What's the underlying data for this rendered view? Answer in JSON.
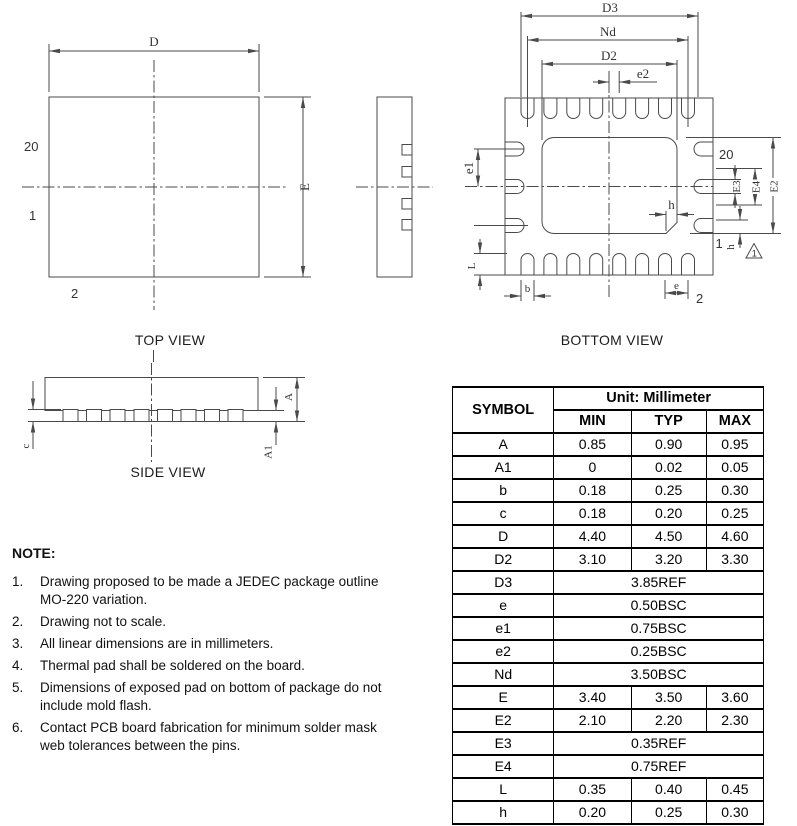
{
  "top_view": {
    "title": "TOP VIEW",
    "dim_d": "D",
    "dim_e": "E",
    "pin20": "20",
    "pin1": "1",
    "pin2": "2"
  },
  "bottom_view": {
    "title": "BOTTOM VIEW",
    "dim_d3": "D3",
    "dim_nd": "Nd",
    "dim_d2": "D2",
    "dim_e2": "e2",
    "dim_e1": "e1",
    "dim_E3": "E3",
    "dim_E4": "E4",
    "dim_E2": "E2",
    "dim_h_chamfer": "h",
    "dim_h_side": "h",
    "dim_L": "L",
    "dim_b": "b",
    "dim_e": "e",
    "pin20": "20",
    "pin1": "1",
    "pin2": "2",
    "rev_marker": "1"
  },
  "side_view": {
    "title": "SIDE VIEW",
    "dim_c": "c",
    "dim_A": "A",
    "dim_A1": "A1"
  },
  "notes": {
    "heading": "NOTE:",
    "items": [
      {
        "num": "1.",
        "text": "Drawing proposed to be made a JEDEC package outline MO-220 variation."
      },
      {
        "num": "2.",
        "text": "Drawing not to scale."
      },
      {
        "num": "3.",
        "text": "All linear dimensions are in millimeters."
      },
      {
        "num": "4.",
        "text": "Thermal pad shall be soldered on the board."
      },
      {
        "num": "5.",
        "text": "Dimensions of exposed pad on bottom of package do not include mold flash."
      },
      {
        "num": "6.",
        "text": "Contact PCB board fabrication for minimum solder mask web tolerances between the pins."
      }
    ]
  },
  "table": {
    "symbol_header": "SYMBOL",
    "unit_header": "Unit: Millimeter",
    "col_headers": [
      "MIN",
      "TYP",
      "MAX"
    ],
    "rows": [
      {
        "symbol": "A",
        "min": "0.85",
        "typ": "0.90",
        "max": "0.95"
      },
      {
        "symbol": "A1",
        "min": "0",
        "typ": "0.02",
        "max": "0.05"
      },
      {
        "symbol": "b",
        "min": "0.18",
        "typ": "0.25",
        "max": "0.30"
      },
      {
        "symbol": "c",
        "min": "0.18",
        "typ": "0.20",
        "max": "0.25"
      },
      {
        "symbol": "D",
        "min": "4.40",
        "typ": "4.50",
        "max": "4.60"
      },
      {
        "symbol": "D2",
        "min": "3.10",
        "typ": "3.20",
        "max": "3.30"
      },
      {
        "symbol": "D3",
        "span": "3.85REF"
      },
      {
        "symbol": "e",
        "span": "0.50BSC"
      },
      {
        "symbol": "e1",
        "span": "0.75BSC"
      },
      {
        "symbol": "e2",
        "span": "0.25BSC"
      },
      {
        "symbol": "Nd",
        "span": "3.50BSC"
      },
      {
        "symbol": "E",
        "min": "3.40",
        "typ": "3.50",
        "max": "3.60"
      },
      {
        "symbol": "E2",
        "min": "2.10",
        "typ": "2.20",
        "max": "2.30"
      },
      {
        "symbol": "E3",
        "span": "0.35REF"
      },
      {
        "symbol": "E4",
        "span": "0.75REF"
      },
      {
        "symbol": "L",
        "min": "0.35",
        "typ": "0.40",
        "max": "0.45"
      },
      {
        "symbol": "h",
        "min": "0.20",
        "typ": "0.25",
        "max": "0.30"
      }
    ]
  }
}
